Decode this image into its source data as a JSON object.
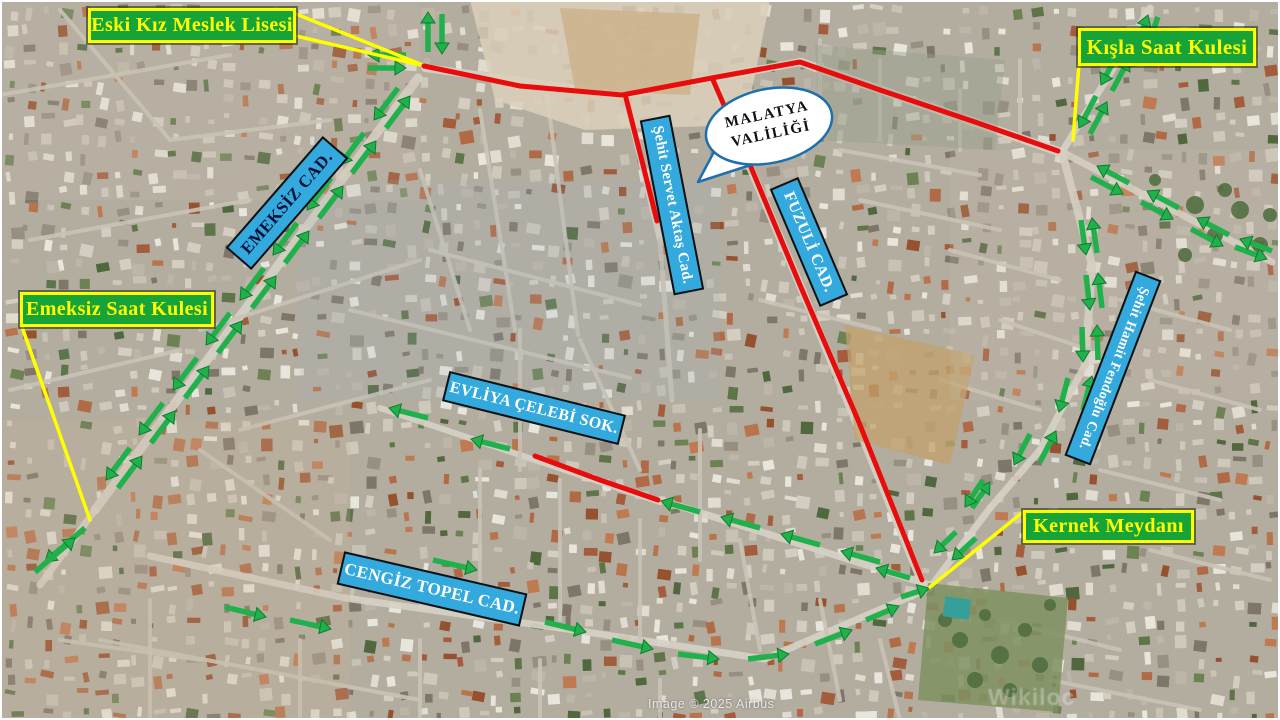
{
  "map": {
    "title": "Malatya city centre annotated satellite map",
    "colors": {
      "landmark_bg": "#16a338",
      "landmark_text": "#ffff00",
      "street_bg": "#33a9dd",
      "route_red": "#e90c0c",
      "arrow_green": "#21b14c",
      "arrow_green_edge": "#0f7c2c",
      "pointer_yellow": "#ffff00",
      "callout_border": "#1d6fae",
      "callout_fill": "#ffffff"
    },
    "landmarks": [
      {
        "id": "eski-kiz-meslek-lisesi",
        "label": "Eski Kız Meslek Lisesi",
        "x": 88,
        "y": 8,
        "w": 208,
        "h": 35,
        "fs": 20
      },
      {
        "id": "kisla-saat-kulesi",
        "label": "Kışla Saat Kulesi",
        "x": 1078,
        "y": 28,
        "w": 178,
        "h": 38,
        "fs": 21
      },
      {
        "id": "emeksiz-saat-kulesi",
        "label": "Emeksiz Saat Kulesi",
        "x": 20,
        "y": 292,
        "w": 194,
        "h": 35,
        "fs": 20
      },
      {
        "id": "kernek-meydani",
        "label": "Kernek Meydanı",
        "x": 1023,
        "y": 510,
        "w": 171,
        "h": 33,
        "fs": 20
      }
    ],
    "streets": [
      {
        "id": "emeksiz-cad",
        "label": "EMEKSİZ CAD.",
        "cx": 287,
        "cy": 203,
        "len": 148,
        "h": 34,
        "angle": -49,
        "fs": 17,
        "color": "#071038"
      },
      {
        "id": "sehit-servet-aktas-cad",
        "label": "Şehit Servet Aktaş Cad.",
        "cx": 672,
        "cy": 205,
        "len": 178,
        "h": 31,
        "angle": 79,
        "fs": 15,
        "color": "#ffffff"
      },
      {
        "id": "fuzuli-cad",
        "label": "FUZULİ CAD.",
        "cx": 809,
        "cy": 242,
        "len": 128,
        "h": 31,
        "angle": 67,
        "fs": 16,
        "color": "#ffffff"
      },
      {
        "id": "sehit-hamit-fendoglu-cad",
        "label": "Şehit Hamit Fendoğlu Cad.",
        "cx": 1113,
        "cy": 368,
        "len": 198,
        "h": 28,
        "angle": 111,
        "fs": 14,
        "color": "#ffffff"
      },
      {
        "id": "evliya-celebi-sok",
        "label": "EVLİYA ÇELEBİ SOK.",
        "cx": 534,
        "cy": 408,
        "len": 182,
        "h": 31,
        "angle": 14,
        "fs": 16,
        "color": "#ffffff"
      },
      {
        "id": "cengiz-topel-cad",
        "label": "CENGİZ TOPEL CAD.",
        "cx": 432,
        "cy": 589,
        "len": 188,
        "h": 34,
        "angle": 13,
        "fs": 17,
        "color": "#ffffff"
      }
    ],
    "callout": {
      "id": "malatya-valiligi",
      "lines": [
        "MALATYA",
        "VALİLİĞİ"
      ],
      "cx": 769,
      "cy": 126,
      "rx": 64,
      "ry": 37,
      "angle": -12
    },
    "routes_red": [
      [
        [
          424,
          66
        ],
        [
          520,
          86
        ],
        [
          622,
          95
        ],
        [
          717,
          77
        ],
        [
          800,
          62
        ],
        [
          880,
          90
        ],
        [
          975,
          122
        ],
        [
          1058,
          151
        ]
      ],
      [
        [
          626,
          98
        ],
        [
          643,
          165
        ],
        [
          657,
          221
        ]
      ],
      [
        [
          713,
          80
        ],
        [
          748,
          160
        ],
        [
          800,
          285
        ],
        [
          858,
          420
        ],
        [
          922,
          580
        ]
      ],
      [
        [
          535,
          456
        ],
        [
          600,
          480
        ],
        [
          658,
          500
        ]
      ]
    ],
    "pointers_yellow": [
      [
        [
          296,
          14
        ],
        [
          425,
          66
        ]
      ],
      [
        [
          296,
          36
        ],
        [
          425,
          66
        ]
      ],
      [
        [
          1079,
          64
        ],
        [
          1073,
          140
        ]
      ],
      [
        [
          22,
          327
        ],
        [
          90,
          520
        ]
      ],
      [
        [
          1023,
          512
        ],
        [
          930,
          587
        ]
      ]
    ],
    "arrows_green": [
      [
        428,
        52,
        428,
        12
      ],
      [
        442,
        14,
        442,
        54
      ],
      [
        406,
        55,
        368,
        55
      ],
      [
        368,
        68,
        406,
        68
      ],
      [
        386,
        128,
        410,
        96
      ],
      [
        398,
        88,
        374,
        120
      ],
      [
        352,
        173,
        376,
        141
      ],
      [
        364,
        133,
        340,
        165
      ],
      [
        319,
        218,
        343,
        186
      ],
      [
        331,
        178,
        307,
        210
      ],
      [
        285,
        263,
        309,
        231
      ],
      [
        297,
        223,
        273,
        255
      ],
      [
        252,
        308,
        276,
        276
      ],
      [
        264,
        268,
        240,
        300
      ],
      [
        218,
        353,
        242,
        321
      ],
      [
        230,
        313,
        206,
        345
      ],
      [
        185,
        398,
        209,
        366
      ],
      [
        197,
        358,
        173,
        390
      ],
      [
        151,
        443,
        175,
        411
      ],
      [
        163,
        403,
        139,
        435
      ],
      [
        118,
        488,
        142,
        456
      ],
      [
        130,
        448,
        106,
        480
      ],
      [
        85,
        528,
        45,
        562
      ],
      [
        35,
        572,
        75,
        538
      ],
      [
        1090,
        134,
        1107,
        102
      ],
      [
        1096,
        96,
        1079,
        128
      ],
      [
        1112,
        91,
        1129,
        59
      ],
      [
        1118,
        53,
        1101,
        85
      ],
      [
        1136,
        48,
        1148,
        15
      ],
      [
        1158,
        17,
        1146,
        50
      ],
      [
        1091,
        177,
        1123,
        194
      ],
      [
        1129,
        183,
        1097,
        166
      ],
      [
        1141,
        202,
        1173,
        219
      ],
      [
        1179,
        208,
        1147,
        191
      ],
      [
        1191,
        229,
        1223,
        246
      ],
      [
        1229,
        235,
        1197,
        218
      ],
      [
        1235,
        247,
        1267,
        259
      ],
      [
        1272,
        251,
        1240,
        239
      ],
      [
        1097,
        253,
        1092,
        218
      ],
      [
        1081,
        220,
        1086,
        255
      ],
      [
        1102,
        308,
        1098,
        273
      ],
      [
        1086,
        275,
        1090,
        310
      ],
      [
        1098,
        360,
        1097,
        325
      ],
      [
        1082,
        327,
        1083,
        362
      ],
      [
        1083,
        410,
        1092,
        376
      ],
      [
        1068,
        378,
        1059,
        412
      ],
      [
        1040,
        462,
        1056,
        431
      ],
      [
        1030,
        434,
        1014,
        465
      ],
      [
        972,
        508,
        990,
        482
      ],
      [
        983,
        480,
        965,
        507
      ],
      [
        976,
        538,
        952,
        560
      ],
      [
        956,
        532,
        934,
        553
      ],
      [
        700,
        512,
        661,
        501
      ],
      [
        760,
        528,
        721,
        517
      ],
      [
        820,
        545,
        781,
        534
      ],
      [
        880,
        562,
        841,
        551
      ],
      [
        910,
        578,
        876,
        568
      ],
      [
        428,
        418,
        389,
        408
      ],
      [
        510,
        449,
        471,
        439
      ],
      [
        433,
        560,
        477,
        570
      ],
      [
        225,
        607,
        266,
        617
      ],
      [
        290,
        620,
        331,
        629
      ],
      [
        545,
        622,
        586,
        632
      ],
      [
        612,
        640,
        653,
        649
      ],
      [
        678,
        654,
        719,
        659
      ],
      [
        748,
        659,
        789,
        654
      ],
      [
        815,
        644,
        852,
        630
      ],
      [
        866,
        620,
        899,
        606
      ],
      [
        901,
        597,
        929,
        588
      ]
    ],
    "watermark": {
      "attribution": "Image © 2025 Airbus",
      "logo": "Wikiloc"
    }
  }
}
